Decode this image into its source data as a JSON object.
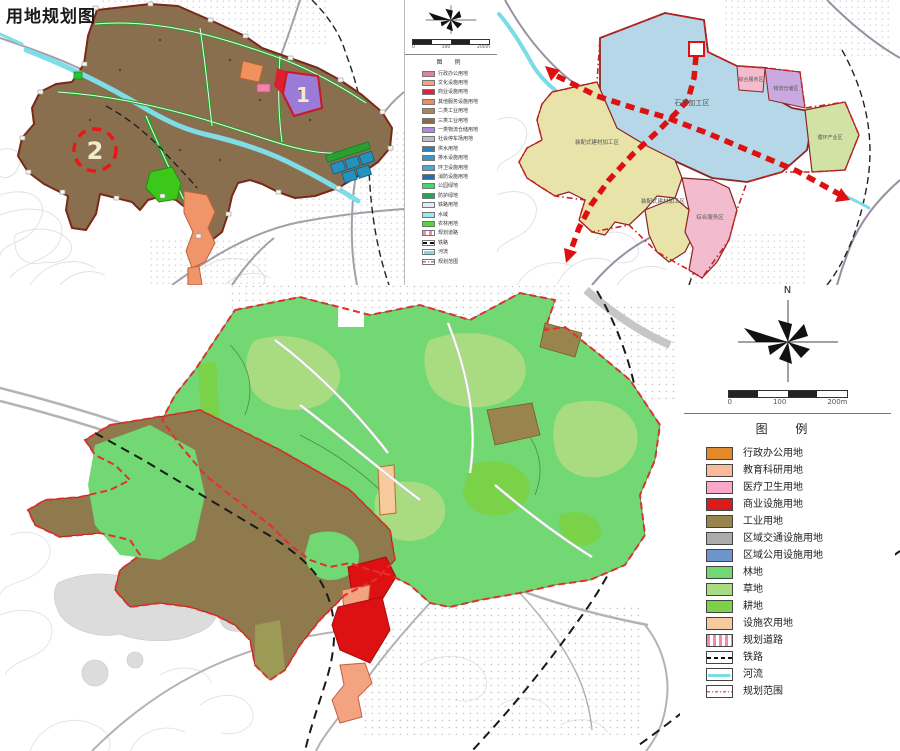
{
  "page": {
    "title": "用地规划图"
  },
  "map1": {
    "title": "用地规划图",
    "markers": [
      {
        "label": "1"
      },
      {
        "label": "2"
      }
    ],
    "scale": {
      "start": "0",
      "mid": "100",
      "end": "200m"
    },
    "legend": {
      "heading": "图 例",
      "items": [
        {
          "label": "行政办公用地",
          "color": "#e0809a"
        },
        {
          "label": "文化设施用地",
          "color": "#f2a385"
        },
        {
          "label": "商业设施用地",
          "color": "#e02048"
        },
        {
          "label": "其他服务设施用地",
          "color": "#ef8d55"
        },
        {
          "label": "二类工业用地",
          "color": "#a8865f"
        },
        {
          "label": "三类工业用地",
          "color": "#8a6c48"
        },
        {
          "label": "一类物流仓储用地",
          "color": "#b08ae0"
        },
        {
          "label": "社会停车场用地",
          "color": "#bcbcc4"
        },
        {
          "label": "供水用地",
          "color": "#2f7fb8"
        },
        {
          "label": "排水设施用地",
          "color": "#3f93c9"
        },
        {
          "label": "环卫设施用地",
          "color": "#52a5d5"
        },
        {
          "label": "消防设施用地",
          "color": "#2a6aa8"
        },
        {
          "label": "公园绿地",
          "color": "#3ddb66"
        },
        {
          "label": "防护绿地",
          "color": "#23a94d"
        },
        {
          "label": "铁路用地",
          "color": "#e9e9f2"
        },
        {
          "label": "水域",
          "color": "#9fe8f2"
        },
        {
          "label": "农林用地",
          "color": "#55d832"
        },
        {
          "label": "规划道路",
          "type": "road"
        },
        {
          "label": "铁路",
          "type": "rail"
        },
        {
          "label": "河流",
          "type": "river"
        },
        {
          "label": "规划范围",
          "type": "range"
        }
      ]
    }
  },
  "map2": {
    "zones": [
      {
        "label": "石材加工区"
      },
      {
        "label": "装配式建材加工区"
      },
      {
        "label": "装配式建材加工区"
      },
      {
        "label": "综合服务区"
      },
      {
        "label": "物流仓储区"
      },
      {
        "label": "循环产业区"
      },
      {
        "label": "综合服务区"
      }
    ]
  },
  "map3": {
    "compass": {
      "north": "N"
    },
    "scale": {
      "start": "0",
      "mid": "100",
      "end": "200m"
    },
    "legend": {
      "heading": "图 例",
      "items": [
        {
          "label": "行政办公用地",
          "color": "#e1892b"
        },
        {
          "label": "教育科研用地",
          "color": "#f7bb9c"
        },
        {
          "label": "医疗卫生用地",
          "color": "#f8a9cb"
        },
        {
          "label": "商业设施用地",
          "color": "#d81c1c"
        },
        {
          "label": "工业用地",
          "color": "#9a844e"
        },
        {
          "label": "区域交通设施用地",
          "color": "#ababab"
        },
        {
          "label": "区域公用设施用地",
          "color": "#6c95ca"
        },
        {
          "label": "林地",
          "color": "#72d873"
        },
        {
          "label": "草地",
          "color": "#a9dc80"
        },
        {
          "label": "耕地",
          "color": "#79d247"
        },
        {
          "label": "设施农用地",
          "color": "#f6ca9d"
        },
        {
          "label": "规划道路",
          "type": "road"
        },
        {
          "label": "铁路",
          "type": "rail"
        },
        {
          "label": "河流",
          "type": "river"
        },
        {
          "label": "规划范围",
          "type": "range"
        }
      ]
    }
  }
}
